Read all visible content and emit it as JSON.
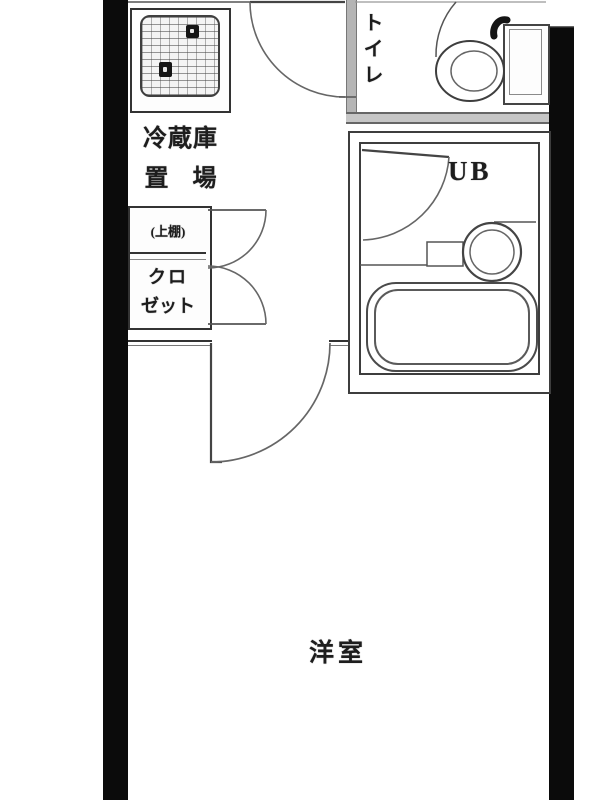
{
  "document": {
    "type": "apartment-floor-plan",
    "description": "Japanese one-room apartment floor plan (madori), cropped at top and bottom"
  },
  "labels": {
    "refrigerator_space": {
      "line1": "冷蔵庫",
      "line2": "置　場"
    },
    "upper_shelf": "(上棚)",
    "closet": {
      "line1": "クロ",
      "line2": "ゼット"
    },
    "toilet": "トイレ",
    "unit_bath": "UB",
    "western_room": "洋室"
  },
  "fixtures": [
    "kitchen-sink-stove-unit",
    "refrigerator-space",
    "closet-double-doors",
    "toilet-bowl-and-tank",
    "unit-bath-washbasin",
    "unit-bath-bathtub",
    "entrance-door-swing",
    "toilet-door-swing",
    "unit-bath-door-swing",
    "room-door-swing"
  ],
  "colors": {
    "background": "#ffffff",
    "outer_wall": "#0b0b0b",
    "inner_wall_gray": "#b5b5b5",
    "line_dark": "#3d3d3d",
    "line_mid": "#666666"
  }
}
